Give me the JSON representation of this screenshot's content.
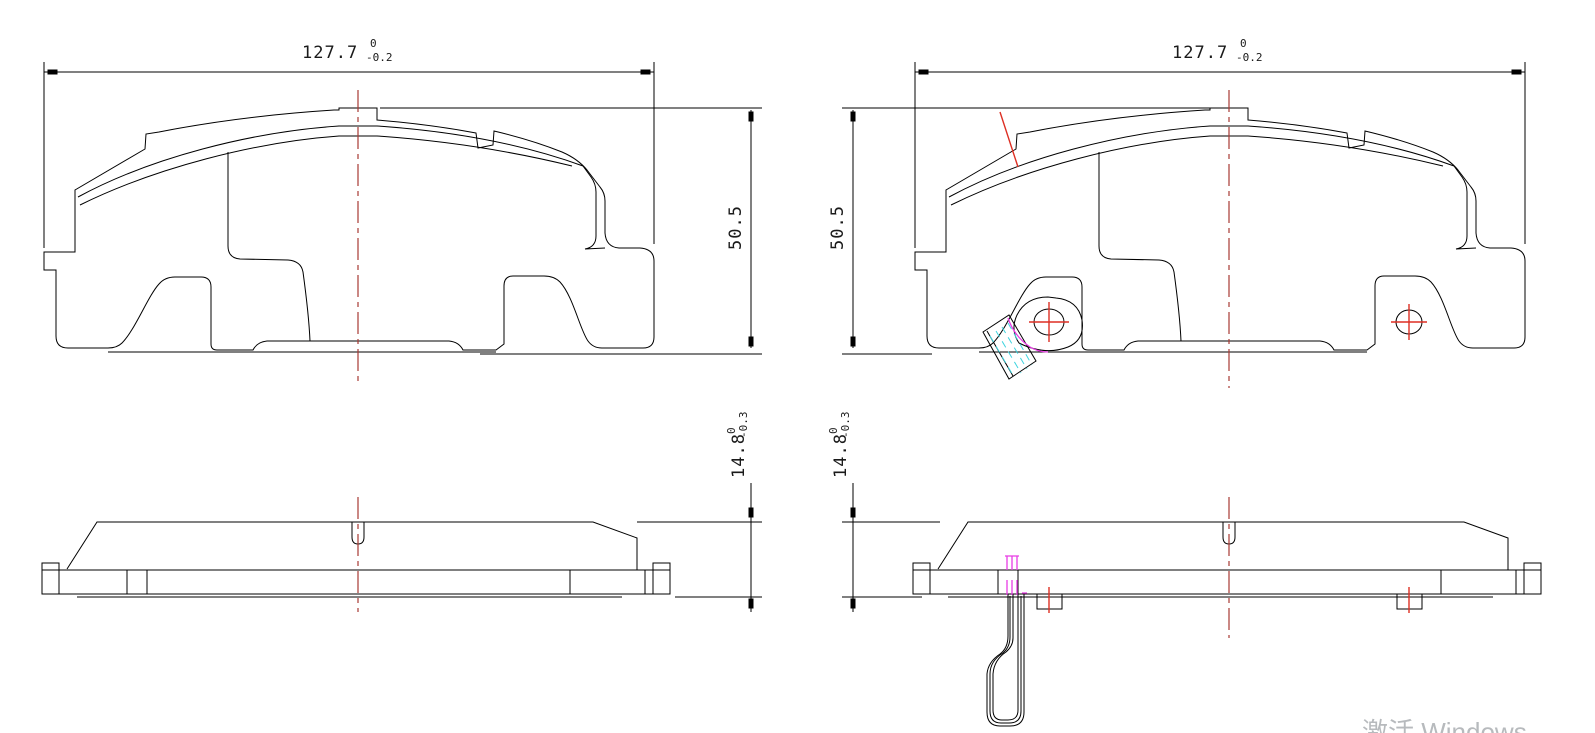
{
  "drawing": {
    "description": "brake pad engineering drawing, two front views and two side views",
    "dimensions": {
      "width_left": {
        "value": "127.7",
        "tol_upper": "0",
        "tol_lower": "-0.2"
      },
      "width_right": {
        "value": "127.7",
        "tol_upper": "0",
        "tol_lower": "-0.2"
      },
      "height_left": {
        "value": "50.5"
      },
      "height_right": {
        "value": "50.5"
      },
      "thickness_left": {
        "value": "14.8",
        "tol_upper": "0",
        "tol_lower": "-0.3"
      },
      "thickness_right": {
        "value": "14.8",
        "tol_upper": "0",
        "tol_lower": "-0.3"
      }
    },
    "colors": {
      "outline": "#000000",
      "centerline": "#a83a34",
      "highlight_red": "#dd2f23",
      "magenta": "#e83ce4",
      "cyan": "#3fd4df",
      "watermark": "#b7babd"
    }
  },
  "watermark": {
    "text": "激活 Windows"
  }
}
